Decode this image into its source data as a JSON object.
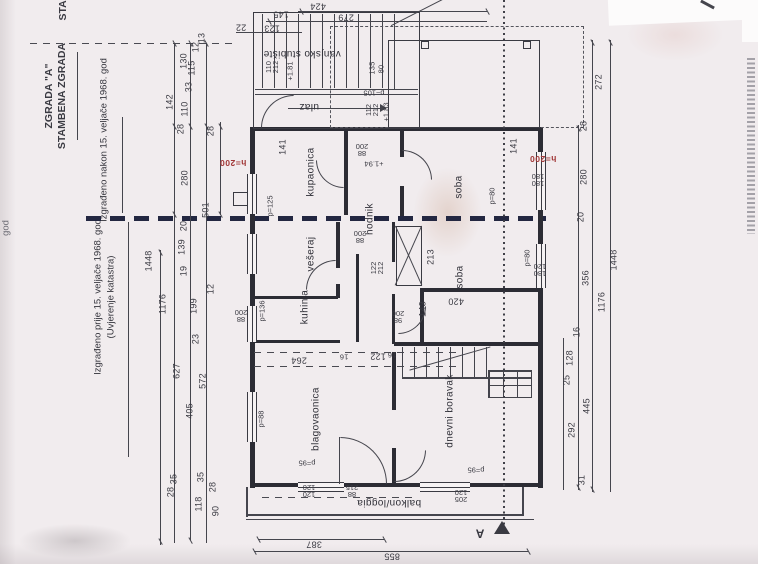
{
  "margin": {
    "partial_top": "STAM",
    "title_line1": "ZGRADA \"A\"",
    "title_line2": "STAMBENA ZGRADA",
    "note_after": "Izgrađeno nakon 15. veljače 1968. god",
    "note_before": "Izgrađeno prije 15. veljače 1968. god",
    "note_before_sub": "(Uvjerenje katastra)",
    "partial_edge": "god"
  },
  "rooms": [
    "kupaonica",
    "vešeraj",
    "kuhinja",
    "hodnik",
    "soba",
    "soba",
    "blagovaonica",
    "dnevni boravak"
  ],
  "areas": {
    "vanjsko_stubiste": "vanjsko stubište",
    "ulaz": "ulaz",
    "balkon": "balkon/loggia"
  },
  "section_marker": "A",
  "red_heights": [
    "h=200",
    "h=200"
  ],
  "dims_left": [
    "13",
    "12",
    "130",
    "115",
    "33",
    "142",
    "110",
    "28",
    "28",
    "280",
    "501",
    "20",
    "139",
    "19",
    "12",
    "1448",
    "199",
    "1176",
    "23",
    "627",
    "572",
    "405",
    "35",
    "28",
    "35",
    "28",
    "118",
    "90"
  ],
  "dims_right": [
    "272",
    "28",
    "280",
    "20",
    "1448",
    "356",
    "1176",
    "16",
    "128",
    "25",
    "445",
    "292",
    "31"
  ],
  "dims_top": [
    "424",
    "279",
    "145",
    "123",
    "22"
  ],
  "dims_bottom": [
    "387",
    "855"
  ],
  "dims_inner": [
    "141",
    "141",
    "135",
    "80",
    "213",
    "143",
    "420",
    "264",
    "16",
    "122",
    "16"
  ],
  "annotations": [
    "110\n212",
    "+1.81",
    "112\n212",
    "+1.83",
    "p=105",
    "p=125",
    "88\n200",
    "+1.94",
    "88\n200",
    "122\n212",
    "98\n200",
    "p=80",
    "180\n180",
    "p=80",
    "180\n120",
    "p=136",
    "88\n200",
    "p=88",
    "p=95",
    "p=95",
    "120\n120",
    "88\n215",
    "205\n120"
  ],
  "colors": {
    "ink": "#3a3a42",
    "bold_boundary": "#232741",
    "red_annotation": "#a13737",
    "paper": "#f1ecee"
  }
}
